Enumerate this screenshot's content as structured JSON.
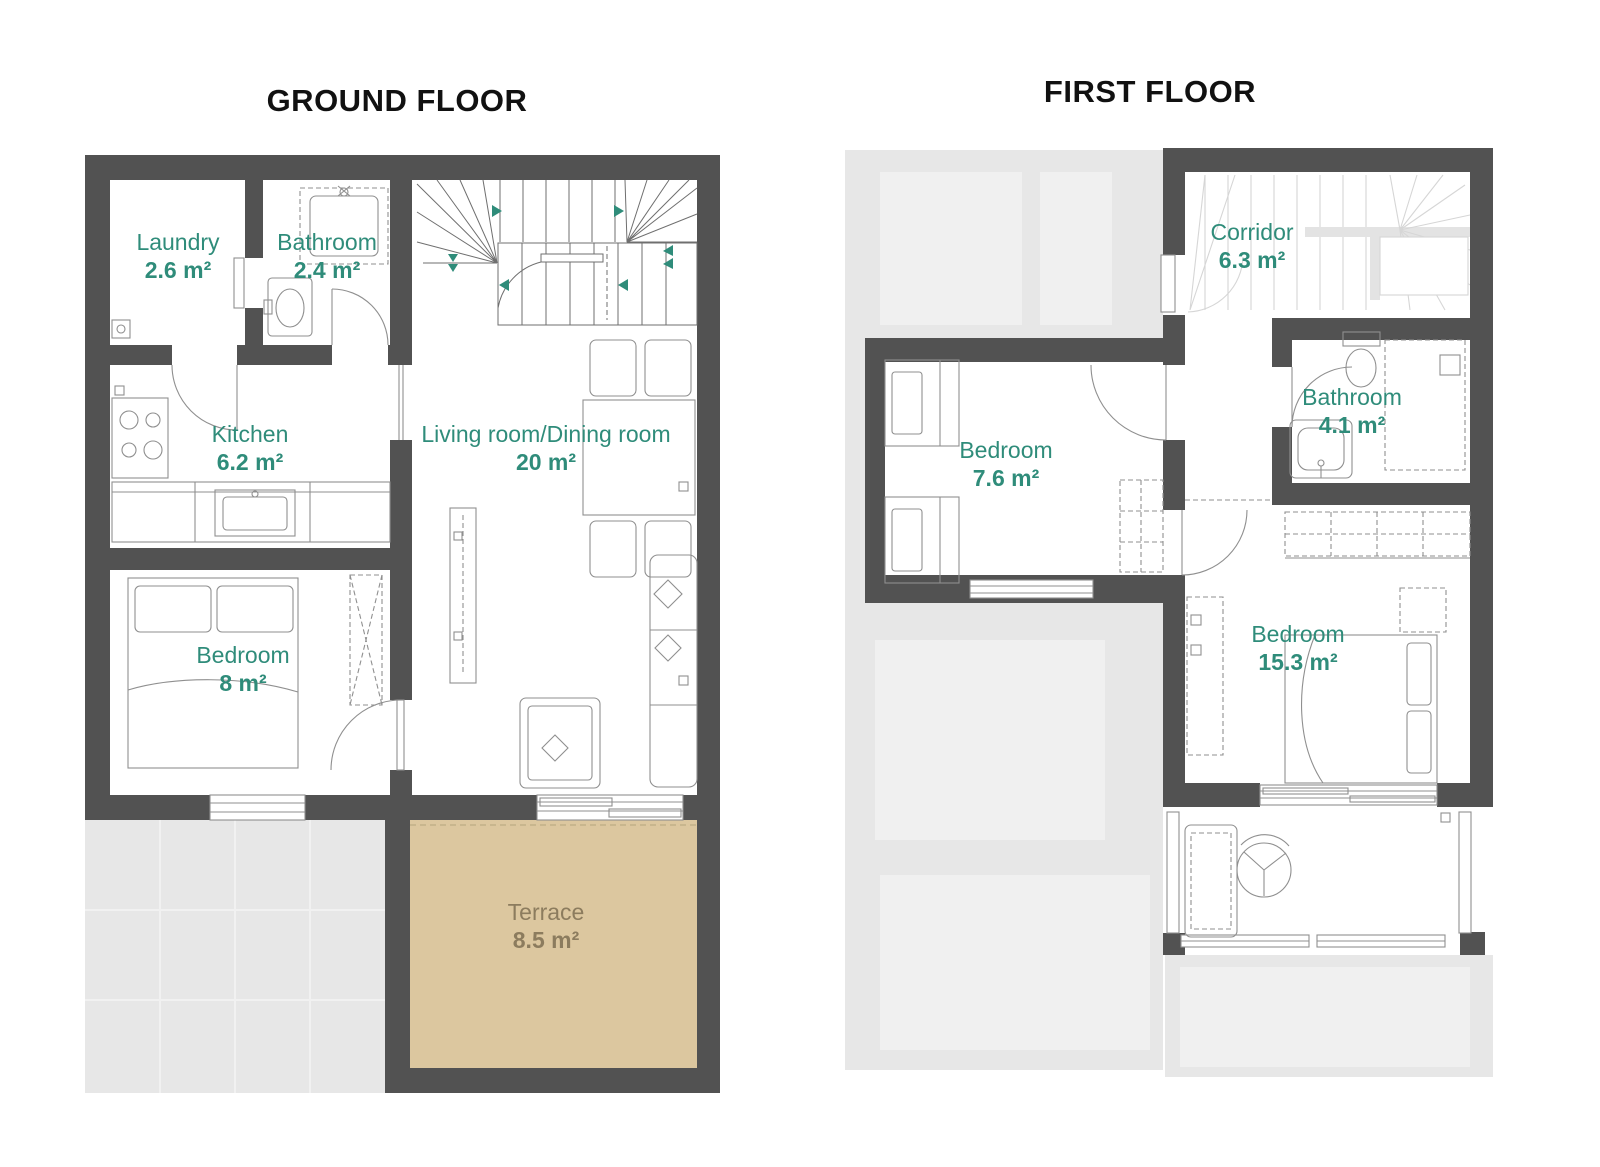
{
  "floors": [
    {
      "id": "ground",
      "title": "GROUND FLOOR",
      "rooms": [
        {
          "name": "Laundry",
          "area": "2.6 m²"
        },
        {
          "name": "Bathroom",
          "area": "2.4 m²"
        },
        {
          "name": "Kitchen",
          "area": "6.2 m²"
        },
        {
          "name": "Living room/Dining room",
          "area": "20 m²"
        },
        {
          "name": "Bedroom",
          "area": "8 m²"
        },
        {
          "name": "Terrace",
          "area": "8.5 m²"
        }
      ]
    },
    {
      "id": "first",
      "title": "FIRST FLOOR",
      "rooms": [
        {
          "name": "Corridor",
          "area": "6.3 m²"
        },
        {
          "name": "Bathroom",
          "area": "4.1 m²"
        },
        {
          "name": "Bedroom",
          "area": "7.6 m²"
        },
        {
          "name": "Bedroom",
          "area": "15.3 m²"
        }
      ]
    }
  ],
  "colors": {
    "wall": "#525252",
    "room_label": "#2f8c7a",
    "terrace_fill": "#dcc79f",
    "terrace_label": "#8c7c5e",
    "exterior": "#e7e7e7",
    "exterior_light": "#f0f0f0",
    "line": "#8f8f8f",
    "faint": "#d6d6d6",
    "title": "#111111"
  }
}
